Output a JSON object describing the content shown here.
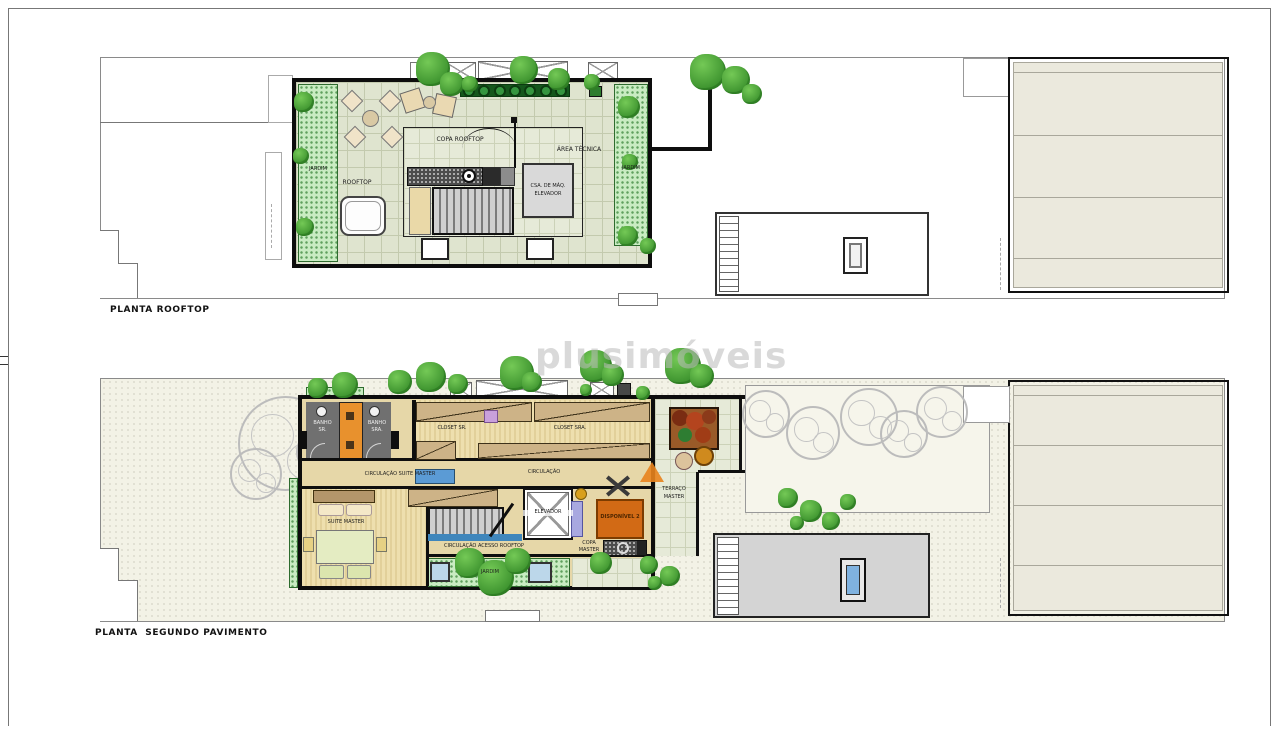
{
  "watermark": "plusimóveis",
  "plan_rooftop": {
    "title": "PLANTA ROOFTOP",
    "labels": {
      "copa_rooftop": "COPA ROOFTOP",
      "area_tecnica": "ÁREA TÉCNICA",
      "rooftop": "ROOFTOP",
      "casa_maquinas_line1": "CSA. DE MÁQ.",
      "casa_maquinas_line2": "ELEVADOR",
      "jardim_left": "JARDIM",
      "jardim_right": "JARDIM"
    }
  },
  "plan_segundo": {
    "title": "PLANTA  SEGUNDO PAVIMENTO",
    "labels": {
      "banho_sr_line1": "BANHO",
      "banho_sr_line2": "SR.",
      "banho_sra_line1": "BANHO",
      "banho_sra_line2": "SRA.",
      "closet_sr": "CLOSET SR.",
      "closet_sra": "CLOSET SRA.",
      "circulacao_suite_master": "CIRCULAÇÃO SUITE MASTER",
      "circulacao": "CIRCULAÇÃO",
      "suite_master": "SUITE MASTER",
      "elevador": "ELEVADOR",
      "disponivel_2": "DISPONÍVEL 2",
      "circulacao_acesso_rooftop": "CIRCULAÇÃO ACESSO ROOFTOP",
      "copa_master_line1": "COPA",
      "copa_master_line2": "MASTER",
      "terraco_master_line1": "TERRAÇO",
      "terraco_master_line2": "MASTER",
      "jardim": "JARDIM"
    }
  },
  "colors": {
    "wall": "#0e0e0e",
    "garden_green": "#c9ecc2",
    "tree_green": "#3f9530",
    "tile_sage": "#dfe4cf",
    "wood_tan": "#cdb387",
    "orange_unit": "#d26a15",
    "orange_cabinet": "#e8912d",
    "blue_skylight": "#7fb2e0",
    "blue_bench": "#5b9bd5",
    "lilac": "#a8a8e0",
    "gold": "#d8a01d",
    "ground_cream": "#f3f2e6"
  }
}
